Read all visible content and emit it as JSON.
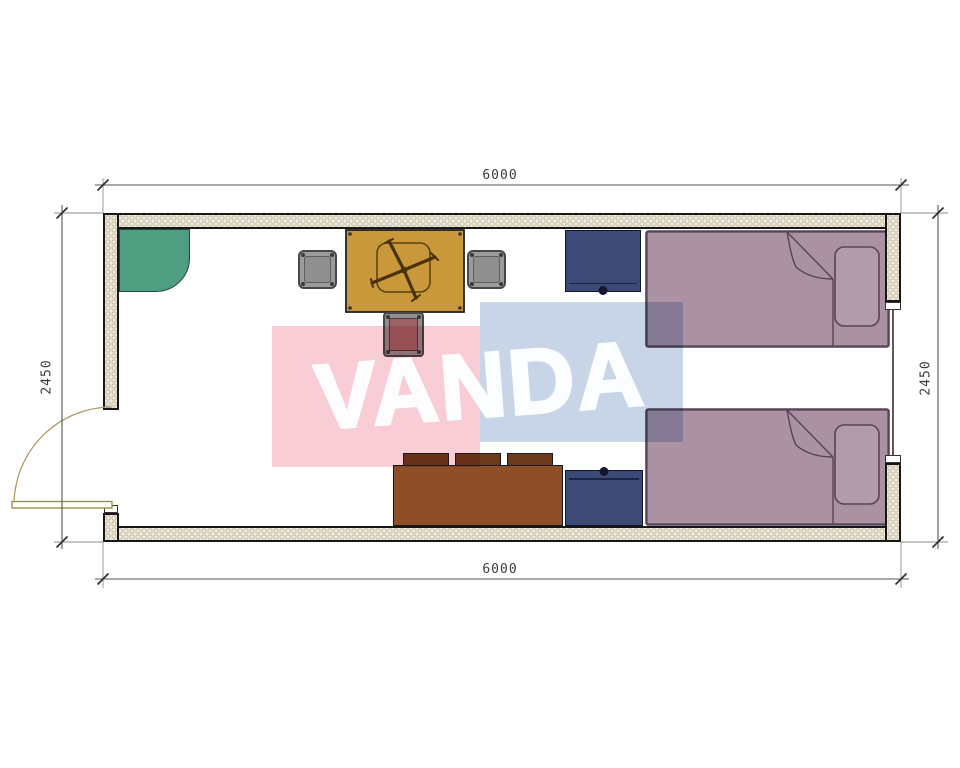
{
  "document": {
    "type": "architectural floor plan",
    "watermark": "VANDA"
  },
  "dimensions": {
    "top": "6000",
    "bottom": "6000",
    "left": "2450",
    "right": "2450"
  },
  "palette": {
    "wall_fill": "#f2ecdf",
    "wall_outline": "#161616",
    "corner_shelf_green": "#4f9e81",
    "table_gold": "#c8983a",
    "chair_gray": "#9b9b9b",
    "stool_maroon": "#9b6366",
    "nightstand_navy": "#3e4a76",
    "bed_mauve": "#aa92a2",
    "bed_outline": "#564458",
    "cabinet_brown": "#8d4e28",
    "door_swing_tan": "#ab9d63",
    "watermark_pink": "#f8cdd5",
    "watermark_blue": "#c7d5e7",
    "dimension_text_gray": "#3c3c3c"
  },
  "furniture": {
    "items": [
      "corner-shelf",
      "dining-table-with-fan",
      "chair",
      "chair",
      "stool",
      "nightstand",
      "single-bed",
      "single-bed",
      "nightstand",
      "drawer-cabinet"
    ],
    "openings": [
      "entry-door-left",
      "window-right"
    ]
  }
}
